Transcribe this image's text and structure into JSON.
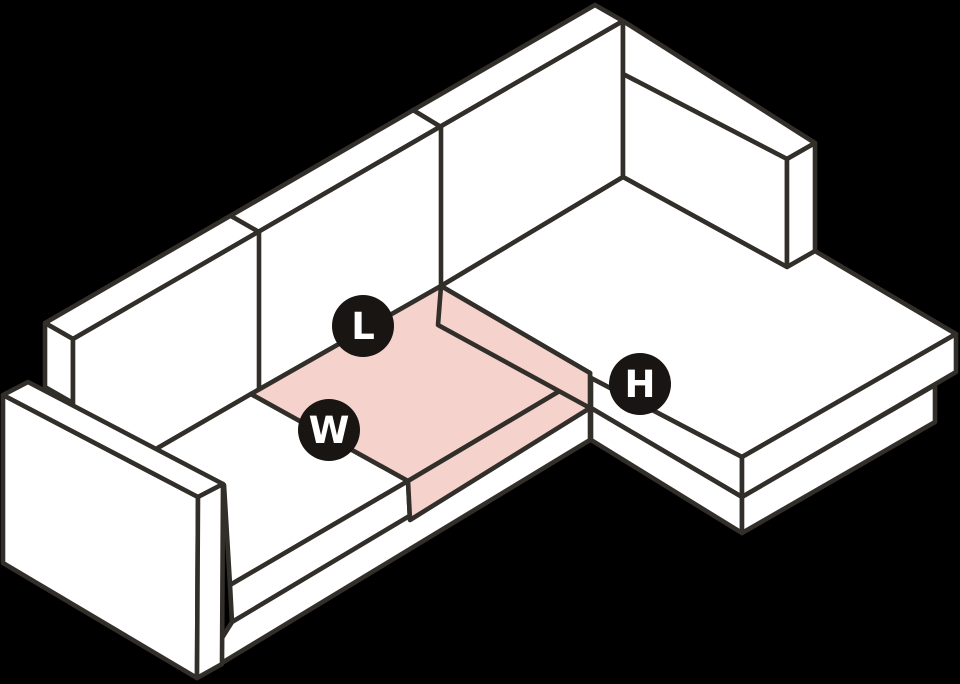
{
  "figure": {
    "title": "sofa-dimensions-diagram",
    "width": 960,
    "height": 684,
    "background_color": "#000000",
    "stroke_color": "#322e2a",
    "stroke_width": 4.6,
    "face_fill_color": "#ffffff",
    "highlight_fill_color": "#f5d3cc",
    "badge_fill_color": "#181512",
    "badge_text_color": "#ffffff",
    "badge_radius": 31,
    "badge_font_size": 37,
    "badges": [
      {
        "id": "length",
        "text": "L",
        "cx": 363,
        "cy": 326
      },
      {
        "id": "width",
        "text": "W",
        "cx": 329,
        "cy": 430
      },
      {
        "id": "height",
        "text": "H",
        "cx": 640,
        "cy": 384
      }
    ],
    "faces": [
      {
        "name": "backrest-top-strip",
        "fill": "white",
        "points": "45,323 595,5 623,21 73,339"
      },
      {
        "name": "backrest-left-end",
        "fill": "white",
        "points": "45,323 73,339 73,403 45,387"
      },
      {
        "name": "backrest-front",
        "fill": "white",
        "points": "73,339 623,21 623,177 441,286 251,394 73,497"
      },
      {
        "name": "chaise-backrest-top-strip",
        "fill": "white",
        "points": "623,21 815,143 787,159 623,74"
      },
      {
        "name": "chaise-backrest-front",
        "fill": "white",
        "points": "623,74 787,159 787,267 623,177"
      },
      {
        "name": "chaise-backrest-end",
        "fill": "white",
        "points": "815,143 815,255 787,267 787,159"
      },
      {
        "name": "chaise-platform-top",
        "fill": "white",
        "points": "441,286 623,177 787,267 815,251 956,334 742,457 591,378 591,408 438,325"
      },
      {
        "name": "chaise-side-upper-band",
        "fill": "white",
        "points": "591,378 742,457 742,497 591,408"
      },
      {
        "name": "chaise-side-lower-band",
        "fill": "white",
        "points": "591,408 742,497 742,533 591,440"
      },
      {
        "name": "chaise-end-upper-band",
        "fill": "white",
        "points": "956,334 956,372 742,497 742,457"
      },
      {
        "name": "chaise-end-base-band",
        "fill": "white",
        "points": "742,497 935,385 935,422 742,533"
      },
      {
        "name": "seat-cushion-top",
        "fill": "white",
        "points": "156,449 251,394 408,481 230,585 224,485"
      },
      {
        "name": "seat-cushion-front-band",
        "fill": "white",
        "points": "230,585 408,481 410,520 232,622"
      },
      {
        "name": "sofa-base-front-band",
        "fill": "white",
        "points": "232,622 590,408 590,440 197,678"
      },
      {
        "name": "highlight-cushion-top",
        "fill": "pink",
        "points": "251,394 441,286 590,373 408,481"
      },
      {
        "name": "highlight-cushion-front",
        "fill": "pink",
        "points": "408,481 590,373 590,408 410,520"
      },
      {
        "name": "highlight-cushion-side",
        "fill": "pink",
        "points": "441,286 590,373 590,408 438,325"
      },
      {
        "name": "armrest-outer-side",
        "fill": "white",
        "points": "3,395 198,497 197,678 3,563"
      },
      {
        "name": "armrest-top-strip",
        "fill": "white",
        "points": "3,395 28,382 223,484 198,497"
      },
      {
        "name": "armrest-front",
        "fill": "white",
        "points": "198,497 223,484 222,664 197,678"
      }
    ],
    "seams": [
      {
        "name": "backrest-seam-1-top",
        "points": "231,216 259,232"
      },
      {
        "name": "backrest-seam-1-face",
        "points": "259,232 259,389"
      },
      {
        "name": "backrest-seam-2-top",
        "points": "413,110 441,127"
      },
      {
        "name": "backrest-seam-2-face",
        "points": "441,127 441,286"
      }
    ]
  }
}
